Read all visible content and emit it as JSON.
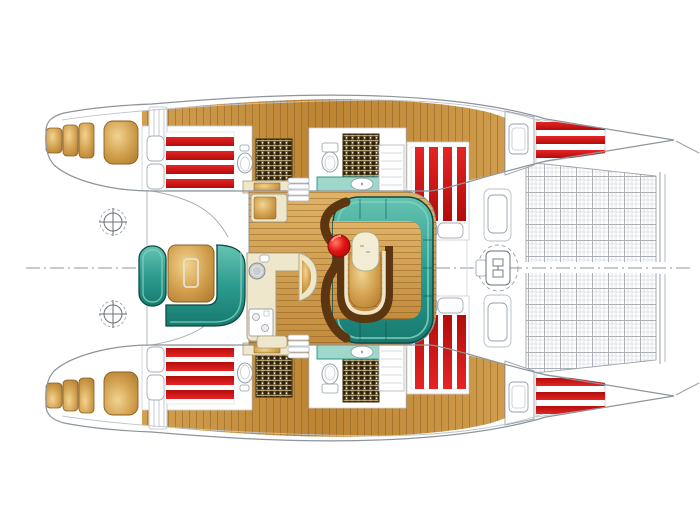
{
  "document": {
    "title": "Sailing catamaran deck and accommodation floor plan, overhead view",
    "vessel": "sailing catamaran",
    "view": "top-down plan"
  },
  "colors": {
    "background": "#ffffff",
    "hullFill": "#ffffff",
    "hullStroke": "#8d949c",
    "lineLight": "#c3c8ce",
    "red": "#e52424",
    "redDark": "#b30c0c",
    "tealHighlight": "#7fd0c0",
    "tealLight": "#66c4b2",
    "teal": "#2d9b8f",
    "tealDeep": "#177a6f",
    "tealStroke": "#0d4a43",
    "vanityTeal": "#9fd8cb",
    "woodSoleA": "#d2a052",
    "woodSoleB": "#bb8433",
    "woodSoleC": "#cf9d4d",
    "floorA": "#e0b366",
    "floorB": "#c28c3c",
    "woodHi": "#f2d491",
    "woodMid": "#cf9c4a",
    "woodDeep": "#a9762a",
    "woodEdge": "#8b5e1f",
    "plankLine": "#7a4a17",
    "brownTrim": "#5c3511",
    "cream": "#efe7cb",
    "creamStroke": "#a99f78",
    "benchCream": "#f3edd6",
    "stoolHi": "#ff7a60",
    "stoolMid": "#e01414",
    "stoolLo": "#9c0606",
    "gridBg": "#5d4a1e",
    "gridDark": "#32230a",
    "gridLight": "#d9c896",
    "netLight": "#c6c9cf",
    "netHeavy": "#9fa4ac",
    "sinkGray": "#c9cdd2",
    "fixtureStroke": "#97a0a8"
  },
  "legend": [
    {
      "id": "cockpit",
      "label": "Aft cockpit seating with teak table"
    },
    {
      "id": "salon",
      "label": "Main salon on bridge deck"
    },
    {
      "id": "galley",
      "label": "L-shaped galley with round sink and two-burner stove"
    },
    {
      "id": "dinette",
      "label": "U-shaped upholstered dinette with horseshoe table, bench and stool"
    },
    {
      "id": "bar-seat",
      "label": "Curved bar seat"
    },
    {
      "id": "aft-cabin",
      "label": "Aft double cabin: striped berth, pillows, toilet, teak shower grating"
    },
    {
      "id": "forward-head",
      "label": "Forward head: toilet, shower grating, vanity sink, shelves"
    },
    {
      "id": "forward-cabin",
      "label": "Forward double cabin: striped berth and pillows"
    },
    {
      "id": "forepeak",
      "label": "Forepeak berth"
    },
    {
      "id": "anchor-locker",
      "label": "Bow locker with deck hatch"
    },
    {
      "id": "foredeck-hatch",
      "label": "Foredeck hatch"
    },
    {
      "id": "mast",
      "label": "Mast step on centerline"
    },
    {
      "id": "trampoline",
      "label": "Bow trampoline net between hulls"
    },
    {
      "id": "stern-steps",
      "label": "Transom swim steps and teak helm pad"
    },
    {
      "id": "propeller-symbol",
      "label": "Propeller / thruster symbol"
    }
  ],
  "counts": {
    "hulls": 2,
    "double_berths": 4,
    "forepeak_berths": 2,
    "pillows": 8,
    "toilets": 4,
    "shower_gratings": 4,
    "deck_hatches": 4,
    "stern_steps_per_hull": 3,
    "dinette_stools": 1
  }
}
